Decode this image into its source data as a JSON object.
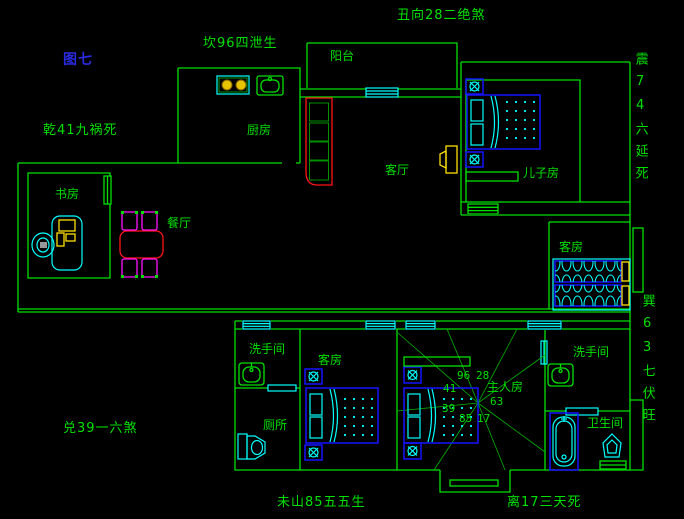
{
  "canvas": {
    "width": 684,
    "height": 519,
    "background": "#000000"
  },
  "palette": {
    "wall_green": "#00e000",
    "label_green": "#00e000",
    "figure_blue": "#2a2ae0",
    "furniture_cyan": "#00ffff",
    "bed_blue": "#1414ff",
    "sofa_red": "#ff1414",
    "chair_magenta": "#ff14ff",
    "appliance_yellow": "#ffe000",
    "background_black": "#000000"
  },
  "figure_label": {
    "text": "图七"
  },
  "fengshui_labels": [
    {
      "id": "chou-top",
      "text": "丑向28二绝煞"
    },
    {
      "id": "kan-topleft",
      "text": "坎96四泄生"
    },
    {
      "id": "qian-left",
      "text": "乾41九祸死"
    },
    {
      "id": "zhen-right",
      "text": "震74六延死"
    },
    {
      "id": "xun-right",
      "text": "巽63七伏旺"
    },
    {
      "id": "dui-bottomleft",
      "text": "兑39一六煞"
    },
    {
      "id": "wei-bottom",
      "text": "未山85五五生"
    },
    {
      "id": "li-bottom",
      "text": "离17三天死"
    }
  ],
  "room_labels": [
    {
      "id": "balcony",
      "text": "阳台"
    },
    {
      "id": "kitchen",
      "text": "厨房"
    },
    {
      "id": "living-room",
      "text": "客厅"
    },
    {
      "id": "sons-room",
      "text": "儿子房"
    },
    {
      "id": "study",
      "text": "书房"
    },
    {
      "id": "dining-room",
      "text": "餐厅"
    },
    {
      "id": "guest-room-right",
      "text": "客房"
    },
    {
      "id": "washroom-left",
      "text": "洗手间"
    },
    {
      "id": "guest-room-bottom",
      "text": "客房"
    },
    {
      "id": "toilet-room",
      "text": "厕所"
    },
    {
      "id": "master-room",
      "text": "主人房"
    },
    {
      "id": "washroom-right",
      "text": "洗手间"
    },
    {
      "id": "bathroom",
      "text": "卫生间"
    }
  ],
  "compass_numbers": [
    "96",
    "28",
    "41",
    "39",
    "85",
    "17",
    "63"
  ],
  "furniture_icons": [
    "sofa",
    "tv-set",
    "dining-table",
    "dining-chair",
    "desk",
    "desk-chair",
    "computer",
    "stove",
    "kitchen-sink",
    "double-bed",
    "single-bed",
    "nightstand-fan",
    "shelf",
    "wash-basin",
    "toilet",
    "bathtub",
    "window",
    "entry-step",
    "direction-compass"
  ]
}
